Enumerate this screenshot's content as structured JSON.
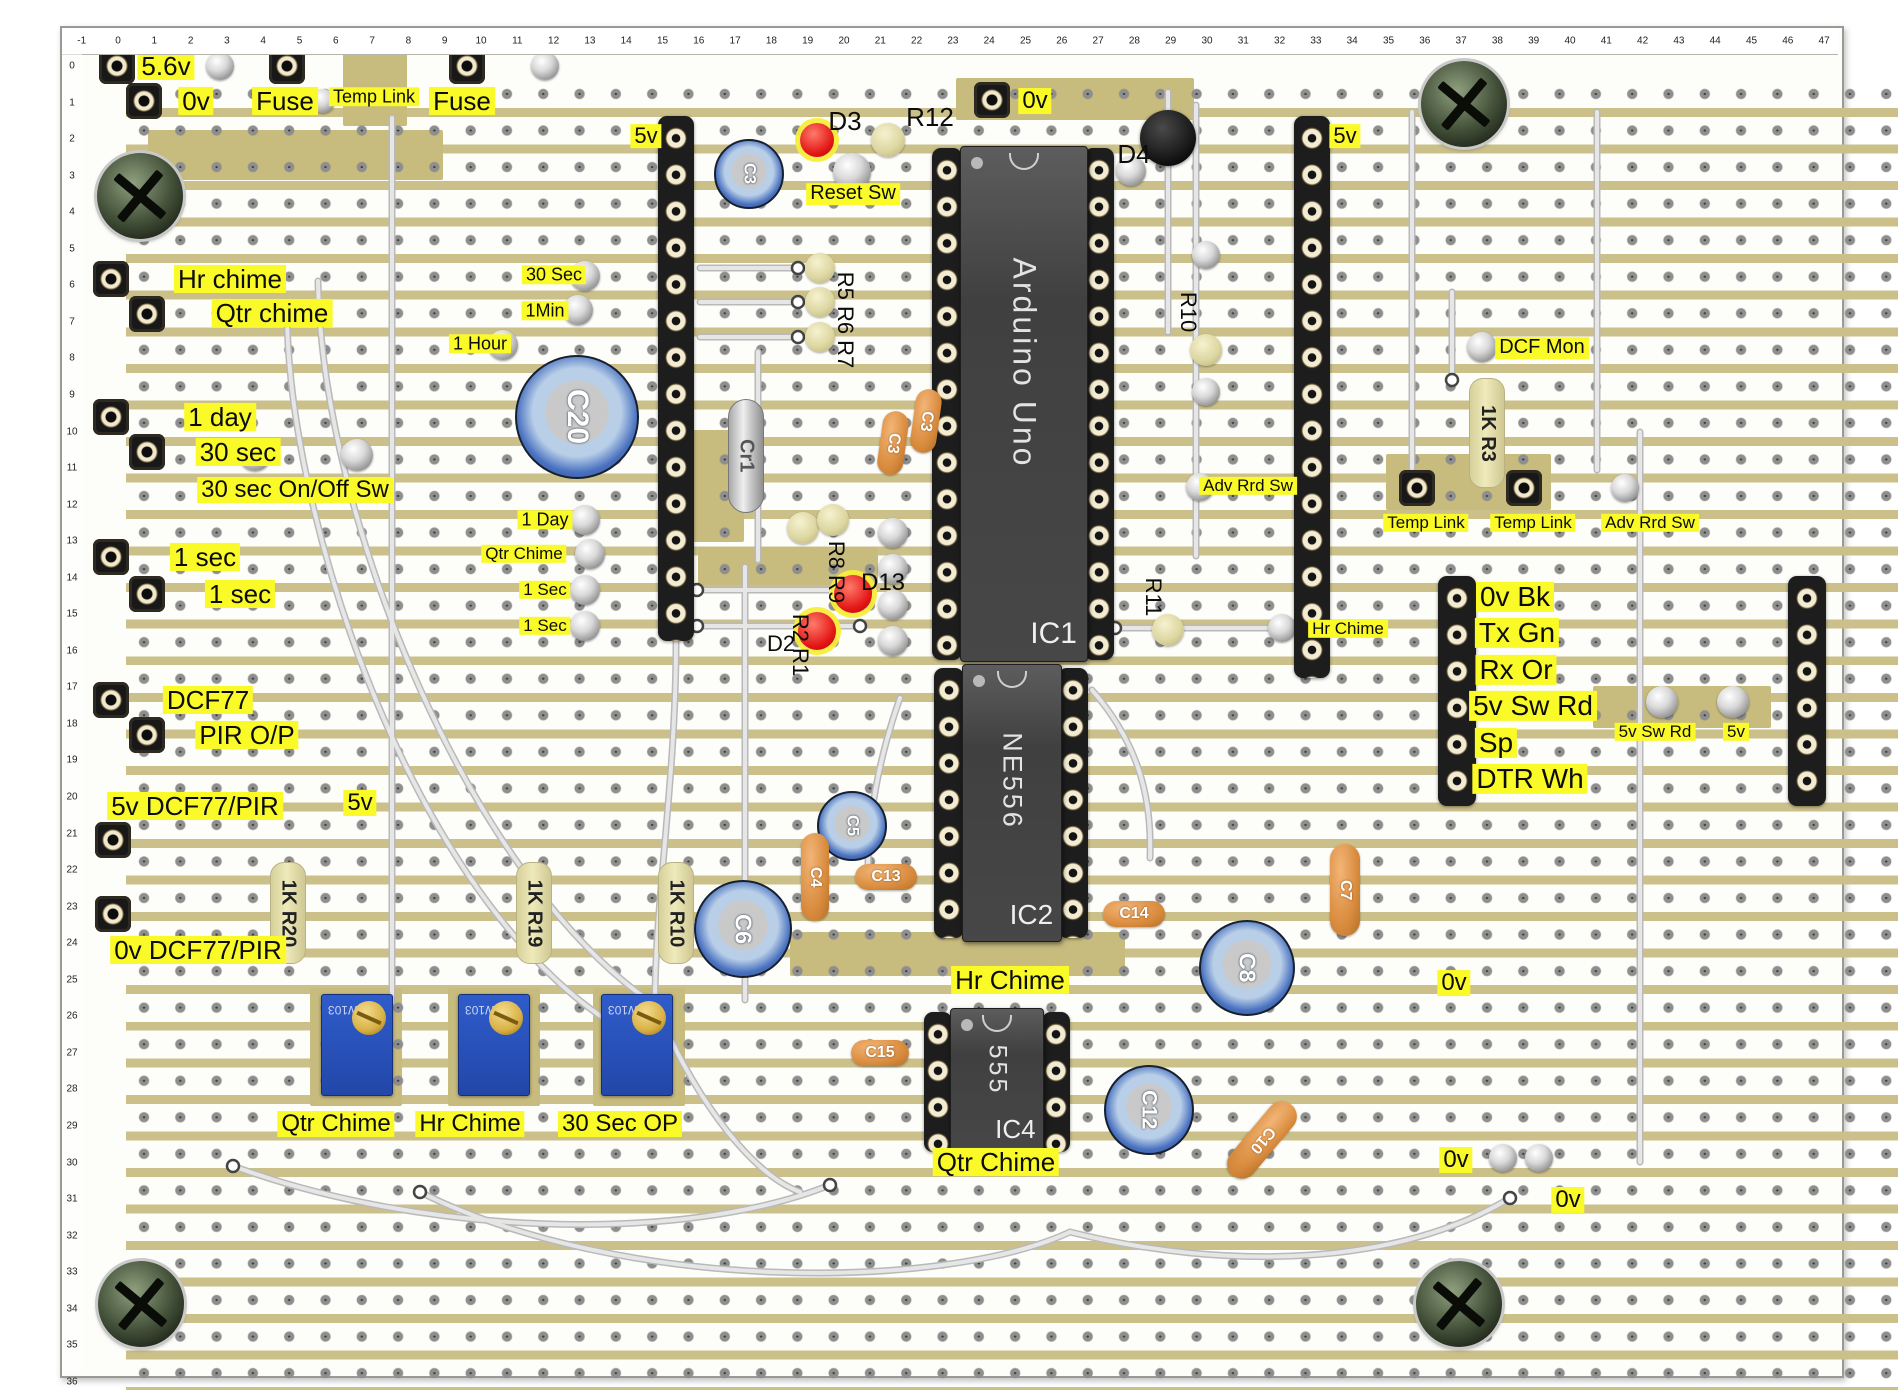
{
  "board": {
    "ruler_top": {
      "start": -1,
      "end": 47
    },
    "ruler_left": {
      "start": 0,
      "end": 36
    },
    "patches": [
      {
        "x": 150,
        "y": 128,
        "w": 295,
        "h": 50
      },
      {
        "x": 345,
        "y": 44,
        "w": 64,
        "h": 80
      },
      {
        "x": 958,
        "y": 76,
        "w": 238,
        "h": 42
      },
      {
        "x": 676,
        "y": 428,
        "w": 70,
        "h": 112
      },
      {
        "x": 1388,
        "y": 452,
        "w": 165,
        "h": 56
      },
      {
        "x": 1595,
        "y": 684,
        "w": 178,
        "h": 42
      },
      {
        "x": 792,
        "y": 930,
        "w": 335,
        "h": 44
      },
      {
        "x": 312,
        "y": 986,
        "w": 92,
        "h": 118
      },
      {
        "x": 450,
        "y": 986,
        "w": 92,
        "h": 118
      },
      {
        "x": 595,
        "y": 986,
        "w": 92,
        "h": 118
      },
      {
        "x": 700,
        "y": 545,
        "w": 180,
        "h": 38
      }
    ]
  },
  "colors": {
    "copper": "#cbc08a",
    "label_bg": "#fafa28",
    "trimmer_blue": "#2f5ccb",
    "led_red": "#e21414",
    "cap_orange": "#d98c3e",
    "cap_blue": "#4a72c0",
    "chip_gray": "#474747"
  },
  "labels": [
    {
      "text": "5.6v",
      "x": 166,
      "y": 66,
      "fs": 26,
      "bg": true
    },
    {
      "text": "0v",
      "x": 196,
      "y": 101,
      "fs": 26,
      "bg": true
    },
    {
      "text": "Fuse",
      "x": 285,
      "y": 101,
      "fs": 26,
      "bg": true
    },
    {
      "text": "Temp Link",
      "x": 374,
      "y": 97,
      "fs": 18,
      "bg": true
    },
    {
      "text": "Fuse",
      "x": 462,
      "y": 101,
      "fs": 26,
      "bg": true
    },
    {
      "text": "5v",
      "x": 646,
      "y": 136,
      "fs": 22,
      "bg": true
    },
    {
      "text": "Reset Sw",
      "x": 853,
      "y": 194,
      "fs": 20,
      "bg": true
    },
    {
      "text": "0v",
      "x": 1035,
      "y": 101,
      "fs": 24,
      "bg": true
    },
    {
      "text": "5v",
      "x": 1345,
      "y": 136,
      "fs": 22,
      "bg": true
    },
    {
      "text": "Hr chime",
      "x": 230,
      "y": 279,
      "fs": 26,
      "bg": true
    },
    {
      "text": "Qtr chime",
      "x": 272,
      "y": 313,
      "fs": 26,
      "bg": true
    },
    {
      "text": "30 Sec",
      "x": 554,
      "y": 275,
      "fs": 18,
      "bg": true
    },
    {
      "text": "1Min",
      "x": 545,
      "y": 311,
      "fs": 18,
      "bg": true
    },
    {
      "text": "1 Hour",
      "x": 480,
      "y": 344,
      "fs": 18,
      "bg": true
    },
    {
      "text": "1 day",
      "x": 220,
      "y": 417,
      "fs": 26,
      "bg": true
    },
    {
      "text": "30 sec",
      "x": 238,
      "y": 452,
      "fs": 26,
      "bg": true
    },
    {
      "text": "30 sec On/Off Sw",
      "x": 295,
      "y": 490,
      "fs": 24,
      "bg": true
    },
    {
      "text": "1 sec",
      "x": 205,
      "y": 557,
      "fs": 26,
      "bg": true
    },
    {
      "text": "1 sec",
      "x": 240,
      "y": 594,
      "fs": 26,
      "bg": true
    },
    {
      "text": "1 Day",
      "x": 545,
      "y": 520,
      "fs": 18,
      "bg": true
    },
    {
      "text": "Qtr Chime",
      "x": 524,
      "y": 554,
      "fs": 17,
      "bg": true
    },
    {
      "text": "1 Sec",
      "x": 545,
      "y": 590,
      "fs": 17,
      "bg": true
    },
    {
      "text": "1 Sec",
      "x": 545,
      "y": 626,
      "fs": 17,
      "bg": true
    },
    {
      "text": "DCF77",
      "x": 208,
      "y": 700,
      "fs": 26,
      "bg": true
    },
    {
      "text": "PIR O/P",
      "x": 247,
      "y": 735,
      "fs": 26,
      "bg": true
    },
    {
      "text": "5v DCF77/PIR",
      "x": 195,
      "y": 806,
      "fs": 26,
      "bg": true
    },
    {
      "text": "5v",
      "x": 360,
      "y": 803,
      "fs": 24,
      "bg": true
    },
    {
      "text": "0v DCF77/PIR",
      "x": 198,
      "y": 950,
      "fs": 26,
      "bg": true
    },
    {
      "text": "Adv Rrd Sw",
      "x": 1248,
      "y": 486,
      "fs": 17,
      "bg": true
    },
    {
      "text": "Hr Chime",
      "x": 1348,
      "y": 629,
      "fs": 17,
      "bg": true
    },
    {
      "text": "DCF Mon",
      "x": 1542,
      "y": 348,
      "fs": 20,
      "bg": true
    },
    {
      "text": "Temp Link",
      "x": 1426,
      "y": 523,
      "fs": 17,
      "bg": true
    },
    {
      "text": "Temp Link",
      "x": 1533,
      "y": 523,
      "fs": 17,
      "bg": true
    },
    {
      "text": "Adv Rrd Sw",
      "x": 1650,
      "y": 523,
      "fs": 17,
      "bg": true
    },
    {
      "text": "0v Bk",
      "x": 1515,
      "y": 597,
      "fs": 28,
      "bg": true
    },
    {
      "text": "Tx Gn",
      "x": 1517,
      "y": 633,
      "fs": 28,
      "bg": true
    },
    {
      "text": "Rx Or",
      "x": 1516,
      "y": 670,
      "fs": 28,
      "bg": true
    },
    {
      "text": "5v Sw Rd",
      "x": 1533,
      "y": 706,
      "fs": 28,
      "bg": true
    },
    {
      "text": "Sp",
      "x": 1496,
      "y": 743,
      "fs": 28,
      "bg": true
    },
    {
      "text": "DTR Wh",
      "x": 1530,
      "y": 779,
      "fs": 28,
      "bg": true
    },
    {
      "text": "5v Sw Rd",
      "x": 1655,
      "y": 732,
      "fs": 17,
      "bg": true
    },
    {
      "text": "5v",
      "x": 1736,
      "y": 732,
      "fs": 17,
      "bg": true
    },
    {
      "text": "Hr Chime",
      "x": 1010,
      "y": 980,
      "fs": 26,
      "bg": true
    },
    {
      "text": "Qtr Chime",
      "x": 996,
      "y": 1162,
      "fs": 26,
      "bg": true
    },
    {
      "text": "Qtr Chime",
      "x": 336,
      "y": 1124,
      "fs": 24,
      "bg": true
    },
    {
      "text": "Hr Chime",
      "x": 470,
      "y": 1124,
      "fs": 24,
      "bg": true
    },
    {
      "text": "30 Sec OP",
      "x": 620,
      "y": 1124,
      "fs": 24,
      "bg": true
    },
    {
      "text": "0v",
      "x": 1454,
      "y": 983,
      "fs": 24,
      "bg": true
    },
    {
      "text": "0v",
      "x": 1456,
      "y": 1160,
      "fs": 24,
      "bg": true
    },
    {
      "text": "0v",
      "x": 1568,
      "y": 1200,
      "fs": 24,
      "bg": true
    },
    {
      "text": "D3",
      "x": 845,
      "y": 121,
      "fs": 26,
      "bg": false
    },
    {
      "text": "R12",
      "x": 930,
      "y": 117,
      "fs": 26,
      "bg": false
    },
    {
      "text": "D4",
      "x": 1134,
      "y": 154,
      "fs": 26,
      "bg": false
    },
    {
      "text": "R5 R6 R7",
      "x": 845,
      "y": 320,
      "fs": 22,
      "bg": false,
      "rot": true
    },
    {
      "text": "R8 R9",
      "x": 836,
      "y": 572,
      "fs": 22,
      "bg": false,
      "rot": true
    },
    {
      "text": "D13",
      "x": 883,
      "y": 583,
      "fs": 24,
      "bg": false
    },
    {
      "text": "D2",
      "x": 781,
      "y": 644,
      "fs": 22,
      "bg": false
    },
    {
      "text": "R2 R1",
      "x": 800,
      "y": 645,
      "fs": 22,
      "bg": false,
      "rot": true
    },
    {
      "text": "R10",
      "x": 1188,
      "y": 312,
      "fs": 22,
      "bg": false,
      "rot": true
    },
    {
      "text": "R11",
      "x": 1153,
      "y": 597,
      "fs": 22,
      "bg": false,
      "rot": true
    }
  ],
  "components": {
    "sockets": [
      {
        "x": 117,
        "y": 66
      },
      {
        "x": 287,
        "y": 66
      },
      {
        "x": 467,
        "y": 66
      },
      {
        "x": 144,
        "y": 101
      },
      {
        "x": 992,
        "y": 100
      },
      {
        "x": 111,
        "y": 279
      },
      {
        "x": 147,
        "y": 314
      },
      {
        "x": 111,
        "y": 417
      },
      {
        "x": 147,
        "y": 452
      },
      {
        "x": 111,
        "y": 557
      },
      {
        "x": 147,
        "y": 594
      },
      {
        "x": 111,
        "y": 700
      },
      {
        "x": 147,
        "y": 735
      },
      {
        "x": 113,
        "y": 840
      },
      {
        "x": 113,
        "y": 914
      },
      {
        "x": 1417,
        "y": 488
      },
      {
        "x": 1524,
        "y": 488
      }
    ],
    "pins": [
      {
        "x": 220,
        "y": 66,
        "d": 28
      },
      {
        "x": 323,
        "y": 101,
        "d": 24
      },
      {
        "x": 545,
        "y": 66,
        "d": 28
      },
      {
        "x": 585,
        "y": 276,
        "d": 30
      },
      {
        "x": 578,
        "y": 310,
        "d": 30
      },
      {
        "x": 503,
        "y": 345,
        "d": 30
      },
      {
        "x": 585,
        "y": 520,
        "d": 30
      },
      {
        "x": 590,
        "y": 554,
        "d": 30
      },
      {
        "x": 585,
        "y": 590,
        "d": 30
      },
      {
        "x": 585,
        "y": 626,
        "d": 30
      },
      {
        "x": 255,
        "y": 455,
        "d": 32
      },
      {
        "x": 357,
        "y": 455,
        "d": 32
      },
      {
        "x": 852,
        "y": 172,
        "d": 38
      },
      {
        "x": 1131,
        "y": 171,
        "d": 30
      },
      {
        "x": 1206,
        "y": 255,
        "d": 28
      },
      {
        "x": 1206,
        "y": 392,
        "d": 28
      },
      {
        "x": 1200,
        "y": 487,
        "d": 28
      },
      {
        "x": 1282,
        "y": 628,
        "d": 28
      },
      {
        "x": 1482,
        "y": 347,
        "d": 30
      },
      {
        "x": 1625,
        "y": 488,
        "d": 28
      },
      {
        "x": 1662,
        "y": 702,
        "d": 32
      },
      {
        "x": 1733,
        "y": 702,
        "d": 32
      },
      {
        "x": 1503,
        "y": 1158,
        "d": 28
      },
      {
        "x": 1539,
        "y": 1158,
        "d": 28
      },
      {
        "x": 893,
        "y": 533,
        "d": 30
      },
      {
        "x": 893,
        "y": 569,
        "d": 30
      },
      {
        "x": 893,
        "y": 605,
        "d": 30
      },
      {
        "x": 893,
        "y": 641,
        "d": 30
      },
      {
        "x": 1168,
        "y": 139,
        "d": 16
      }
    ],
    "beads": [
      {
        "x": 888,
        "y": 140,
        "d": 34
      },
      {
        "x": 820,
        "y": 268,
        "d": 30
      },
      {
        "x": 820,
        "y": 302,
        "d": 30
      },
      {
        "x": 820,
        "y": 337,
        "d": 30
      },
      {
        "x": 1206,
        "y": 350,
        "d": 32
      },
      {
        "x": 1168,
        "y": 630,
        "d": 32
      },
      {
        "x": 803,
        "y": 528,
        "d": 32
      },
      {
        "x": 833,
        "y": 520,
        "d": 32
      }
    ],
    "leds": [
      {
        "name": "led-d3",
        "x": 817,
        "y": 140,
        "d": 34
      },
      {
        "name": "led-d13",
        "x": 853,
        "y": 594,
        "d": 38
      },
      {
        "name": "led-d2",
        "x": 817,
        "y": 631,
        "d": 38
      }
    ],
    "black_discs": [
      {
        "name": "diode-d4",
        "x": 1168,
        "y": 138,
        "d": 56
      }
    ],
    "electrolytics": [
      {
        "label": "C3",
        "x": 747,
        "y": 172,
        "d": 66
      },
      {
        "label": "C20",
        "x": 575,
        "y": 415,
        "d": 120
      },
      {
        "label": "C5",
        "x": 850,
        "y": 824,
        "d": 66
      },
      {
        "label": "C6",
        "x": 741,
        "y": 927,
        "d": 94
      },
      {
        "label": "C8",
        "x": 1245,
        "y": 966,
        "d": 92
      },
      {
        "label": "C12",
        "x": 1147,
        "y": 1108,
        "d": 86
      }
    ],
    "film_caps": [
      {
        "label": "C3",
        "x": 893,
        "y": 443,
        "w": 26,
        "h": 64,
        "rot": 8
      },
      {
        "label": "C3",
        "x": 926,
        "y": 421,
        "w": 26,
        "h": 64,
        "rot": 8
      },
      {
        "label": "C4",
        "x": 815,
        "y": 877,
        "w": 28,
        "h": 88,
        "rot": 0
      },
      {
        "label": "C13",
        "x": 886,
        "y": 877,
        "w": 62,
        "h": 26,
        "rot": 0
      },
      {
        "label": "C14",
        "x": 1134,
        "y": 914,
        "w": 62,
        "h": 26,
        "rot": 0
      },
      {
        "label": "C7",
        "x": 1345,
        "y": 890,
        "w": 30,
        "h": 92,
        "rot": 0
      },
      {
        "label": "C15",
        "x": 880,
        "y": 1053,
        "w": 58,
        "h": 26,
        "rot": 0
      },
      {
        "label": "C10",
        "x": 1262,
        "y": 1140,
        "w": 30,
        "h": 92,
        "rot": 40
      }
    ],
    "crystals": [
      {
        "label": "Cr1",
        "x": 745,
        "y": 455,
        "w": 34,
        "h": 112
      }
    ],
    "resistors": [
      {
        "label": "1K R20",
        "x": 287,
        "y": 912,
        "w": 34,
        "h": 100
      },
      {
        "label": "1K R19",
        "x": 533,
        "y": 912,
        "w": 34,
        "h": 100
      },
      {
        "label": "1K R10",
        "x": 675,
        "y": 912,
        "w": 34,
        "h": 100
      },
      {
        "label": "1K R3",
        "x": 1486,
        "y": 432,
        "w": 34,
        "h": 108
      }
    ],
    "headers": [
      {
        "x": 658,
        "y": 116,
        "w": 36,
        "h": 525
      },
      {
        "x": 1294,
        "y": 116,
        "w": 36,
        "h": 562
      },
      {
        "x": 1438,
        "y": 576,
        "w": 38,
        "h": 230
      },
      {
        "x": 1788,
        "y": 576,
        "w": 38,
        "h": 230
      }
    ],
    "ics": [
      {
        "name": "ic1-arduino",
        "main": "Arduino Uno",
        "sub": "IC1",
        "chip": {
          "x": 960,
          "y": 146,
          "w": 126,
          "h": 514
        },
        "cols": [
          {
            "x": 932,
            "y": 148,
            "w": 30,
            "h": 512
          },
          {
            "x": 1084,
            "y": 148,
            "w": 30,
            "h": 512
          }
        ],
        "main_fs": 32,
        "sub_fs": 30
      },
      {
        "name": "ic2-ne556",
        "main": "NE556",
        "sub": "IC2",
        "chip": {
          "x": 962,
          "y": 664,
          "w": 98,
          "h": 276
        },
        "cols": [
          {
            "x": 934,
            "y": 668,
            "w": 30,
            "h": 270
          },
          {
            "x": 1058,
            "y": 668,
            "w": 30,
            "h": 270
          }
        ],
        "main_fs": 27,
        "sub_fs": 28
      },
      {
        "name": "ic4-555",
        "main": "555",
        "sub": "IC4",
        "chip": {
          "x": 950,
          "y": 1008,
          "w": 92,
          "h": 146
        },
        "cols": [
          {
            "x": 924,
            "y": 1012,
            "w": 28,
            "h": 140
          },
          {
            "x": 1042,
            "y": 1012,
            "w": 28,
            "h": 140
          }
        ],
        "main_fs": 25,
        "sub_fs": 26
      }
    ],
    "trimmers": [
      {
        "x": 321,
        "y": 994,
        "w": 70,
        "h": 100,
        "mark": "W103"
      },
      {
        "x": 458,
        "y": 994,
        "w": 70,
        "h": 100,
        "mark": "W103"
      },
      {
        "x": 601,
        "y": 994,
        "w": 70,
        "h": 100,
        "mark": "W103"
      }
    ],
    "screws": [
      {
        "x": 140,
        "y": 196,
        "d": 86
      },
      {
        "x": 1464,
        "y": 104,
        "d": 86
      },
      {
        "x": 141,
        "y": 1304,
        "d": 86
      },
      {
        "x": 1459,
        "y": 1304,
        "d": 86
      }
    ]
  },
  "wires": {
    "paths": [
      "M392,118 V1002",
      "M318,281 C322,520 470,880 655,1005",
      "M287,316 C290,540 430,940 645,1042",
      "M676,642 C676,780 655,900 655,1002",
      "M697,590 H866",
      "M697,626 H860",
      "M700,268 H798",
      "M700,302 H798",
      "M700,337 H798",
      "M745,567 V1000",
      "M758,352 V560",
      "M1168,92 V332",
      "M1196,105 V556",
      "M1412,112 V468",
      "M1452,292 V380",
      "M1597,112 V470",
      "M1640,432 V1162",
      "M233,1166 C420,1235 680,1245 830,1185",
      "M420,1192 C620,1292 940,1292 1070,1232",
      "M655,1005 C700,1110 755,1175 800,1192",
      "M1070,1232 C1230,1272 1400,1265 1510,1198",
      "M900,698 C878,760 868,820 868,868",
      "M1092,690 C1140,745 1152,800 1150,858",
      "M1115,628 H1276"
    ],
    "rings": [
      [
        697,
        590
      ],
      [
        866,
        590
      ],
      [
        697,
        626
      ],
      [
        860,
        626
      ],
      [
        798,
        268
      ],
      [
        798,
        302
      ],
      [
        798,
        337
      ],
      [
        233,
        1166
      ],
      [
        420,
        1192
      ],
      [
        830,
        1185
      ],
      [
        1510,
        1198
      ],
      [
        1452,
        380
      ],
      [
        1115,
        628
      ],
      [
        1276,
        628
      ]
    ]
  }
}
